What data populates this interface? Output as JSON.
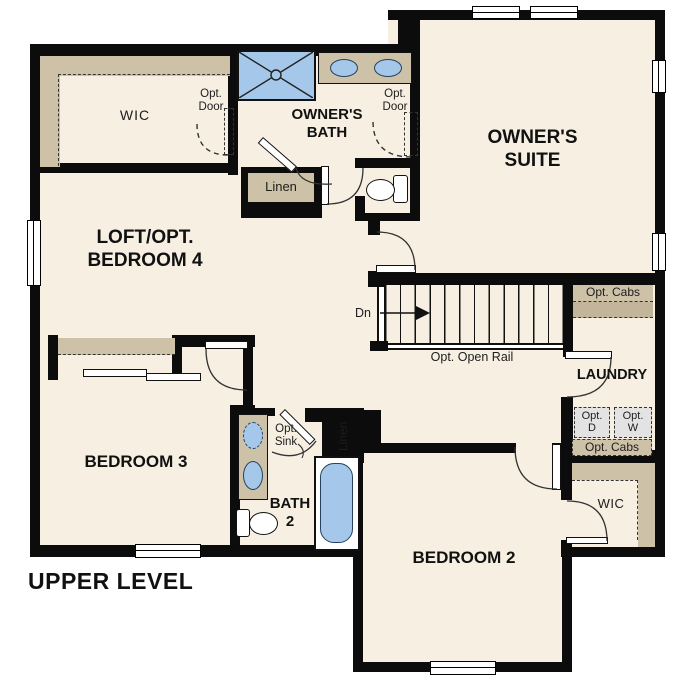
{
  "colors": {
    "wall": "#0c0c0c",
    "floor": "#f6efe2",
    "shelf_tan": "#cdc2a8",
    "shelf_tan_dark": "#c2b59a",
    "fixture_blue": "#a5c7e9",
    "opt_appliance_gray": "#e3e3e3"
  },
  "plan": {
    "footer_title": "UPPER LEVEL",
    "rooms": {
      "wic_owner": {
        "name": "WIC"
      },
      "owners_bath": {
        "line1": "OWNER'S",
        "line2": "BATH"
      },
      "owners_suite": {
        "line1": "OWNER'S",
        "line2": "SUITE"
      },
      "loft": {
        "line1": "LOFT/OPT.",
        "line2": "BEDROOM 4"
      },
      "bedroom3": {
        "name": "BEDROOM 3"
      },
      "bath2": {
        "line1": "BATH",
        "line2": "2"
      },
      "bedroom2": {
        "name": "BEDROOM 2"
      },
      "laundry": {
        "name": "LAUNDRY"
      },
      "wic_bedroom2": {
        "name": "WIC"
      }
    },
    "annotations": {
      "opt_door_wic": {
        "line1": "Opt.",
        "line2": "Door"
      },
      "opt_door_bath": {
        "line1": "Opt.",
        "line2": "Door"
      },
      "linen_upper": {
        "name": "Linen"
      },
      "linen_bath2": {
        "name": "Linen"
      },
      "stairs": {
        "direction": "Dn",
        "rail": "Opt. Open Rail"
      },
      "opt_cabs_upper": {
        "name": "Opt. Cabs"
      },
      "opt_cabs_lower": {
        "name": "Opt. Cabs"
      },
      "opt_dryer": {
        "line1": "Opt.",
        "line2": "D"
      },
      "opt_washer": {
        "line1": "Opt.",
        "line2": "W"
      },
      "opt_sink": {
        "line1": "Opt.",
        "line2": "Sink"
      }
    }
  }
}
